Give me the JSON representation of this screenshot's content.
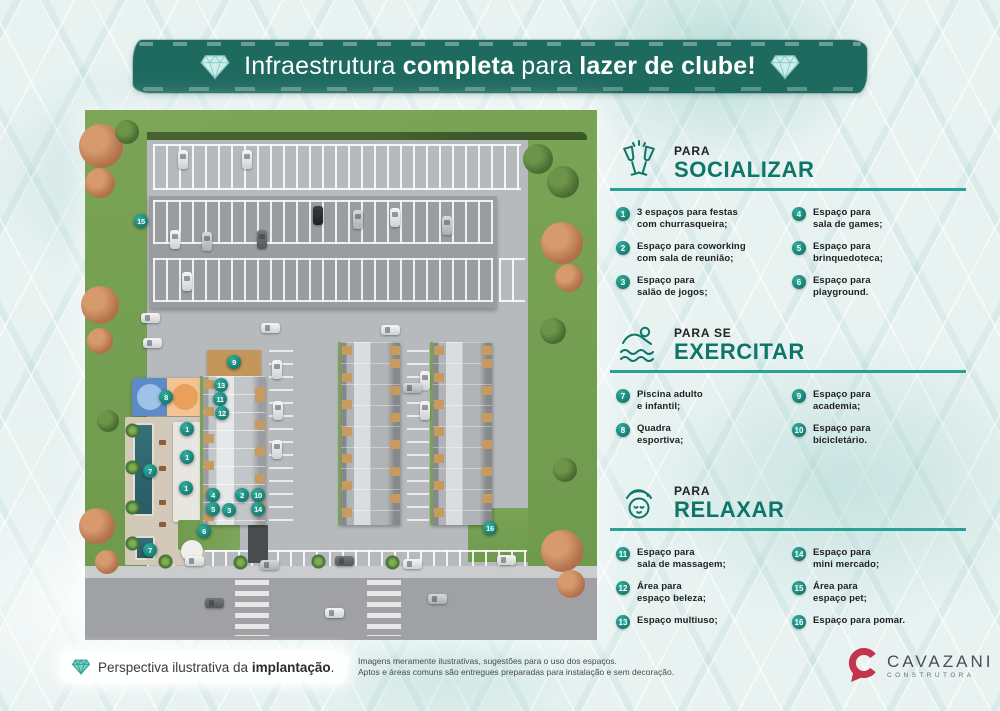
{
  "banner": {
    "parts": [
      {
        "text": "Infraestrutura ",
        "bold": false
      },
      {
        "text": "completa",
        "bold": true
      },
      {
        "text": " para ",
        "bold": false
      },
      {
        "text": "lazer de clube!",
        "bold": true
      }
    ]
  },
  "sections": [
    {
      "id": "socializar",
      "icon": "champagne-toast-icon",
      "kicker": "PARA",
      "title": "SOCIALIZAR",
      "items": [
        {
          "n": 1,
          "col": 1,
          "lines": [
            "3 espaços para festas",
            "com churrasqueira;"
          ]
        },
        {
          "n": 2,
          "col": 1,
          "lines": [
            "Espaço para coworking",
            "com sala de reunião;"
          ]
        },
        {
          "n": 3,
          "col": 1,
          "lines": [
            "Espaço para",
            "salão de jogos;"
          ]
        },
        {
          "n": 4,
          "col": 2,
          "lines": [
            "Espaço para",
            "sala de games;"
          ]
        },
        {
          "n": 5,
          "col": 2,
          "lines": [
            "Espaço para",
            "brinquedoteca;"
          ]
        },
        {
          "n": 6,
          "col": 2,
          "lines": [
            "Espaço para",
            "playground."
          ]
        }
      ]
    },
    {
      "id": "exercitar",
      "icon": "swimmer-icon",
      "kicker": "PARA SE",
      "title": "EXERCITAR",
      "items": [
        {
          "n": 7,
          "col": 1,
          "lines": [
            "Piscina adulto",
            "e infantil;"
          ]
        },
        {
          "n": 8,
          "col": 1,
          "lines": [
            "Quadra",
            "esportiva;"
          ]
        },
        {
          "n": 9,
          "col": 2,
          "lines": [
            "Espaço para",
            "academia;"
          ]
        },
        {
          "n": 10,
          "col": 2,
          "lines": [
            "Espaço para",
            "bicicletário."
          ]
        }
      ]
    },
    {
      "id": "relaxar",
      "icon": "spa-face-icon",
      "kicker": "PARA",
      "title": "RELAXAR",
      "items": [
        {
          "n": 11,
          "col": 1,
          "lines": [
            "Espaço para",
            "sala de massagem;"
          ]
        },
        {
          "n": 12,
          "col": 1,
          "lines": [
            "Área para",
            "espaço beleza;"
          ]
        },
        {
          "n": 13,
          "col": 1,
          "lines": [
            "Espaço multiuso;"
          ]
        },
        {
          "n": 14,
          "col": 2,
          "lines": [
            "Espaço para",
            "mini mercado;"
          ]
        },
        {
          "n": 15,
          "col": 2,
          "lines": [
            "Área para",
            "espaço pet;"
          ]
        },
        {
          "n": 16,
          "col": 2,
          "lines": [
            "Espaço para pomar."
          ]
        }
      ]
    }
  ],
  "map": {
    "markers": [
      {
        "n": "15",
        "x": 56,
        "y": 111
      },
      {
        "n": "9",
        "x": 149,
        "y": 252
      },
      {
        "n": "13",
        "x": 136,
        "y": 275
      },
      {
        "n": "11",
        "x": 135,
        "y": 289
      },
      {
        "n": "12",
        "x": 137,
        "y": 303
      },
      {
        "n": "8",
        "x": 81,
        "y": 287
      },
      {
        "n": "1",
        "x": 102,
        "y": 319
      },
      {
        "n": "1",
        "x": 102,
        "y": 347
      },
      {
        "n": "1",
        "x": 101,
        "y": 378
      },
      {
        "n": "7",
        "x": 65,
        "y": 361
      },
      {
        "n": "7",
        "x": 65,
        "y": 440
      },
      {
        "n": "4",
        "x": 128,
        "y": 385
      },
      {
        "n": "5",
        "x": 128,
        "y": 399
      },
      {
        "n": "3",
        "x": 144,
        "y": 400
      },
      {
        "n": "2",
        "x": 157,
        "y": 385
      },
      {
        "n": "10",
        "x": 173,
        "y": 385
      },
      {
        "n": "14",
        "x": 173,
        "y": 399
      },
      {
        "n": "6",
        "x": 119,
        "y": 421
      },
      {
        "n": "16",
        "x": 405,
        "y": 418
      }
    ]
  },
  "footer": {
    "caption_parts": [
      {
        "text": "Perspectiva ilustrativa da ",
        "bold": false
      },
      {
        "text": "implantação",
        "bold": true
      },
      {
        "text": ".",
        "bold": false
      }
    ],
    "disclaimer_lines": [
      "Imagens meramente ilustrativas, sugestões para o uso dos espaços.",
      "Aptos e áreas comuns são entregues preparadas para instalação e sem decoração."
    ]
  },
  "logo": {
    "name": "CAVAZANI",
    "subtitle": "CONSTRUTORA"
  },
  "colors": {
    "accent": "#0e7669",
    "divider": "#2aa096",
    "banner": "#1e6a5f",
    "badge1": "#2fae9f",
    "badge2": "#0c695e",
    "logo_red": "#c5344e"
  }
}
